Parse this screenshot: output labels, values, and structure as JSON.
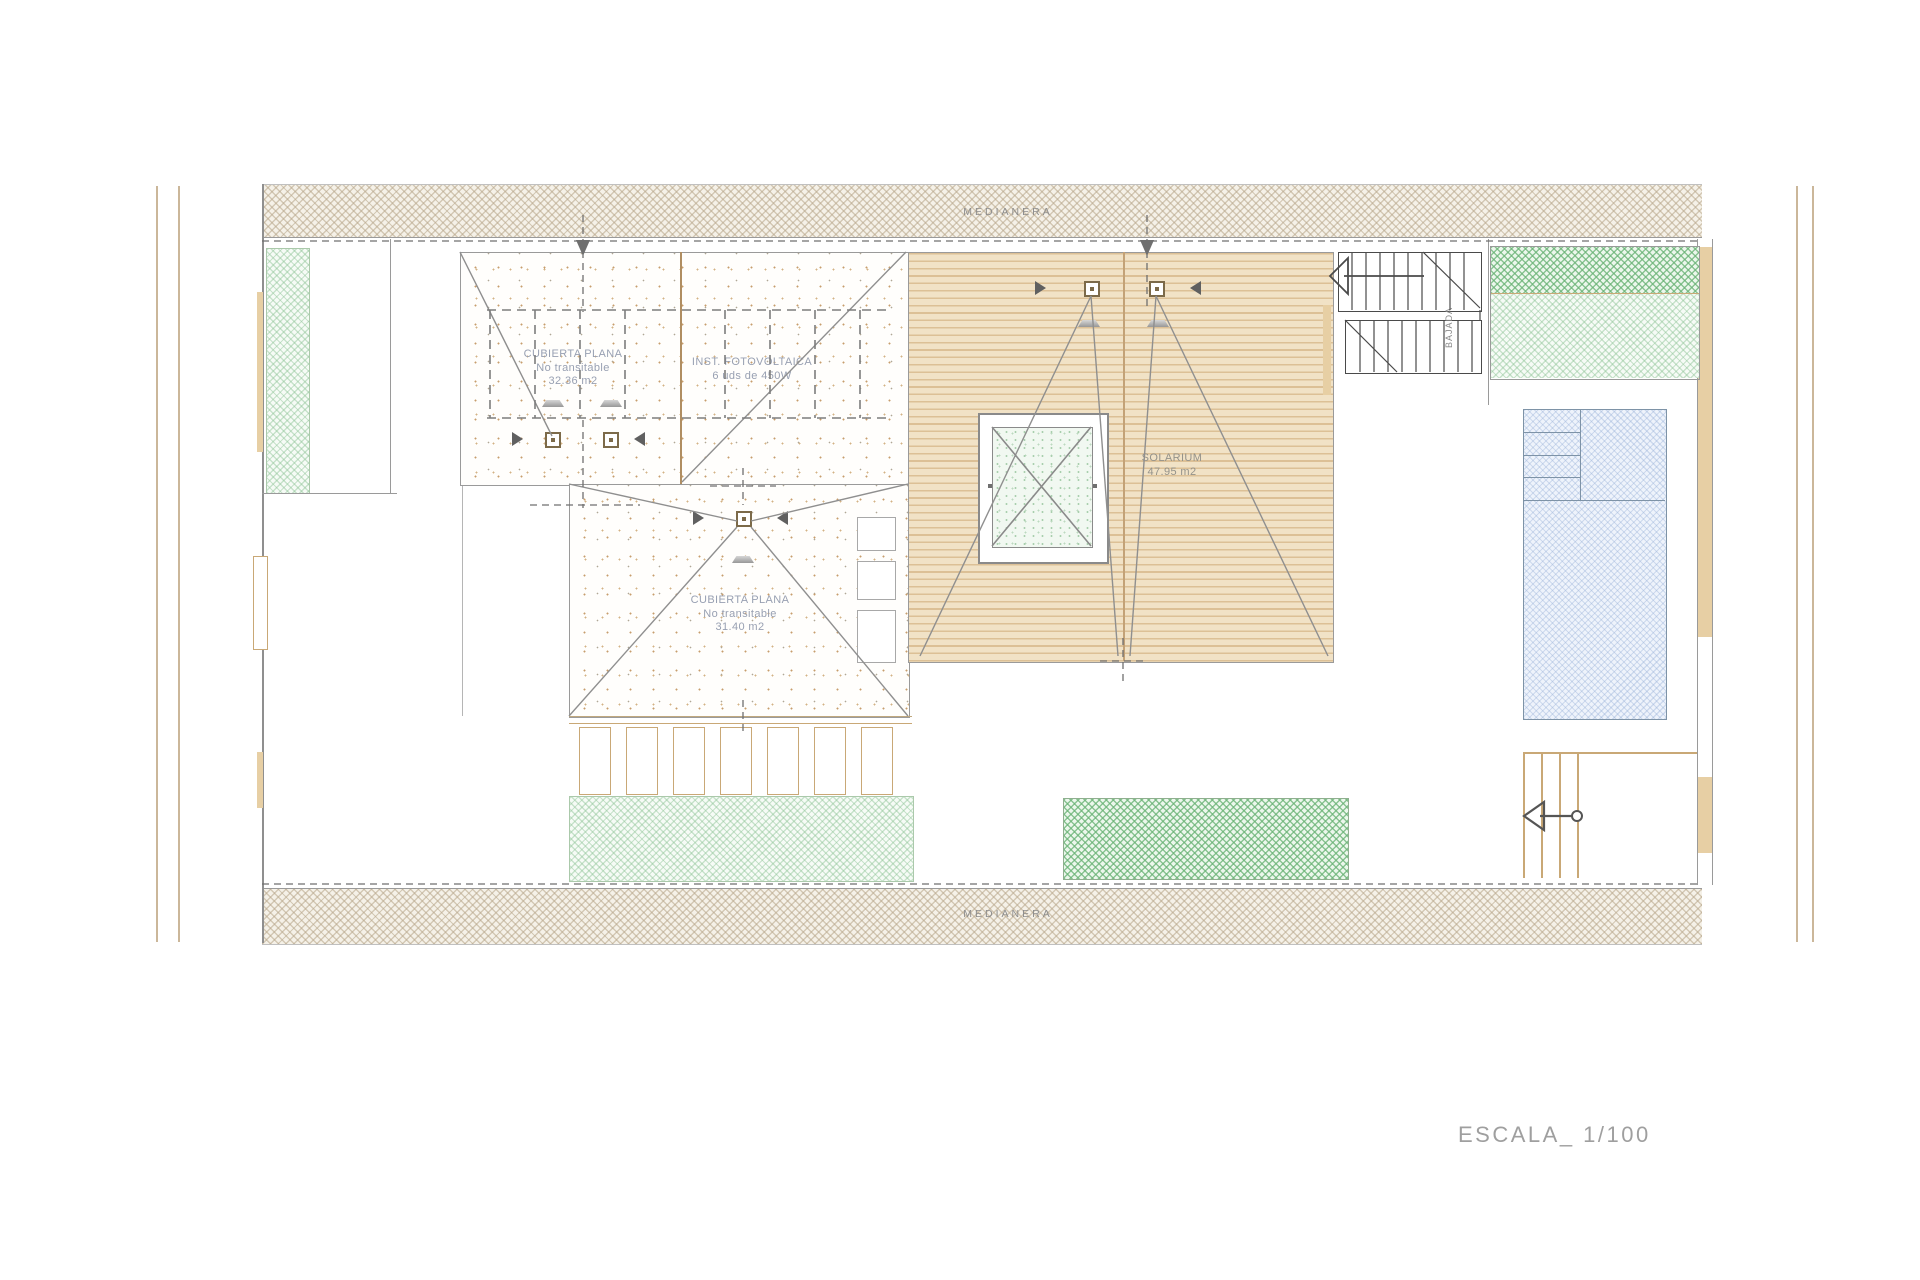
{
  "annotations": {
    "medianera_top": "MEDIANERA",
    "medianera_bottom": "MEDIANERA",
    "roof_a": [
      "CUBIERTA PLANA",
      "No transitable",
      "32.36 m2"
    ],
    "pv": [
      "INST. FOTOVOLTAICA",
      "6 uds de 450W"
    ],
    "roof_b": [
      "CUBIERTA PLANA",
      "No transitable",
      "31.40 m2"
    ],
    "solarium": [
      "SOLARIUM",
      "47.95 m2"
    ],
    "stair_note": "BAJADA",
    "scale_note": "ESCALA_ 1/100"
  },
  "colors": {
    "party_wall_hatch": "#d8cdbb",
    "roof_speckle": "#c79d6d",
    "deck_line": "#dcc096",
    "deck_bg": "#f1e2c6",
    "vegetation_green": "#8ec496",
    "pool_blue": "#c9d9ef",
    "wall_tan": "#e7cfa4",
    "drawing_line": "#8f8f8f",
    "label_text": "#98a0b2"
  }
}
